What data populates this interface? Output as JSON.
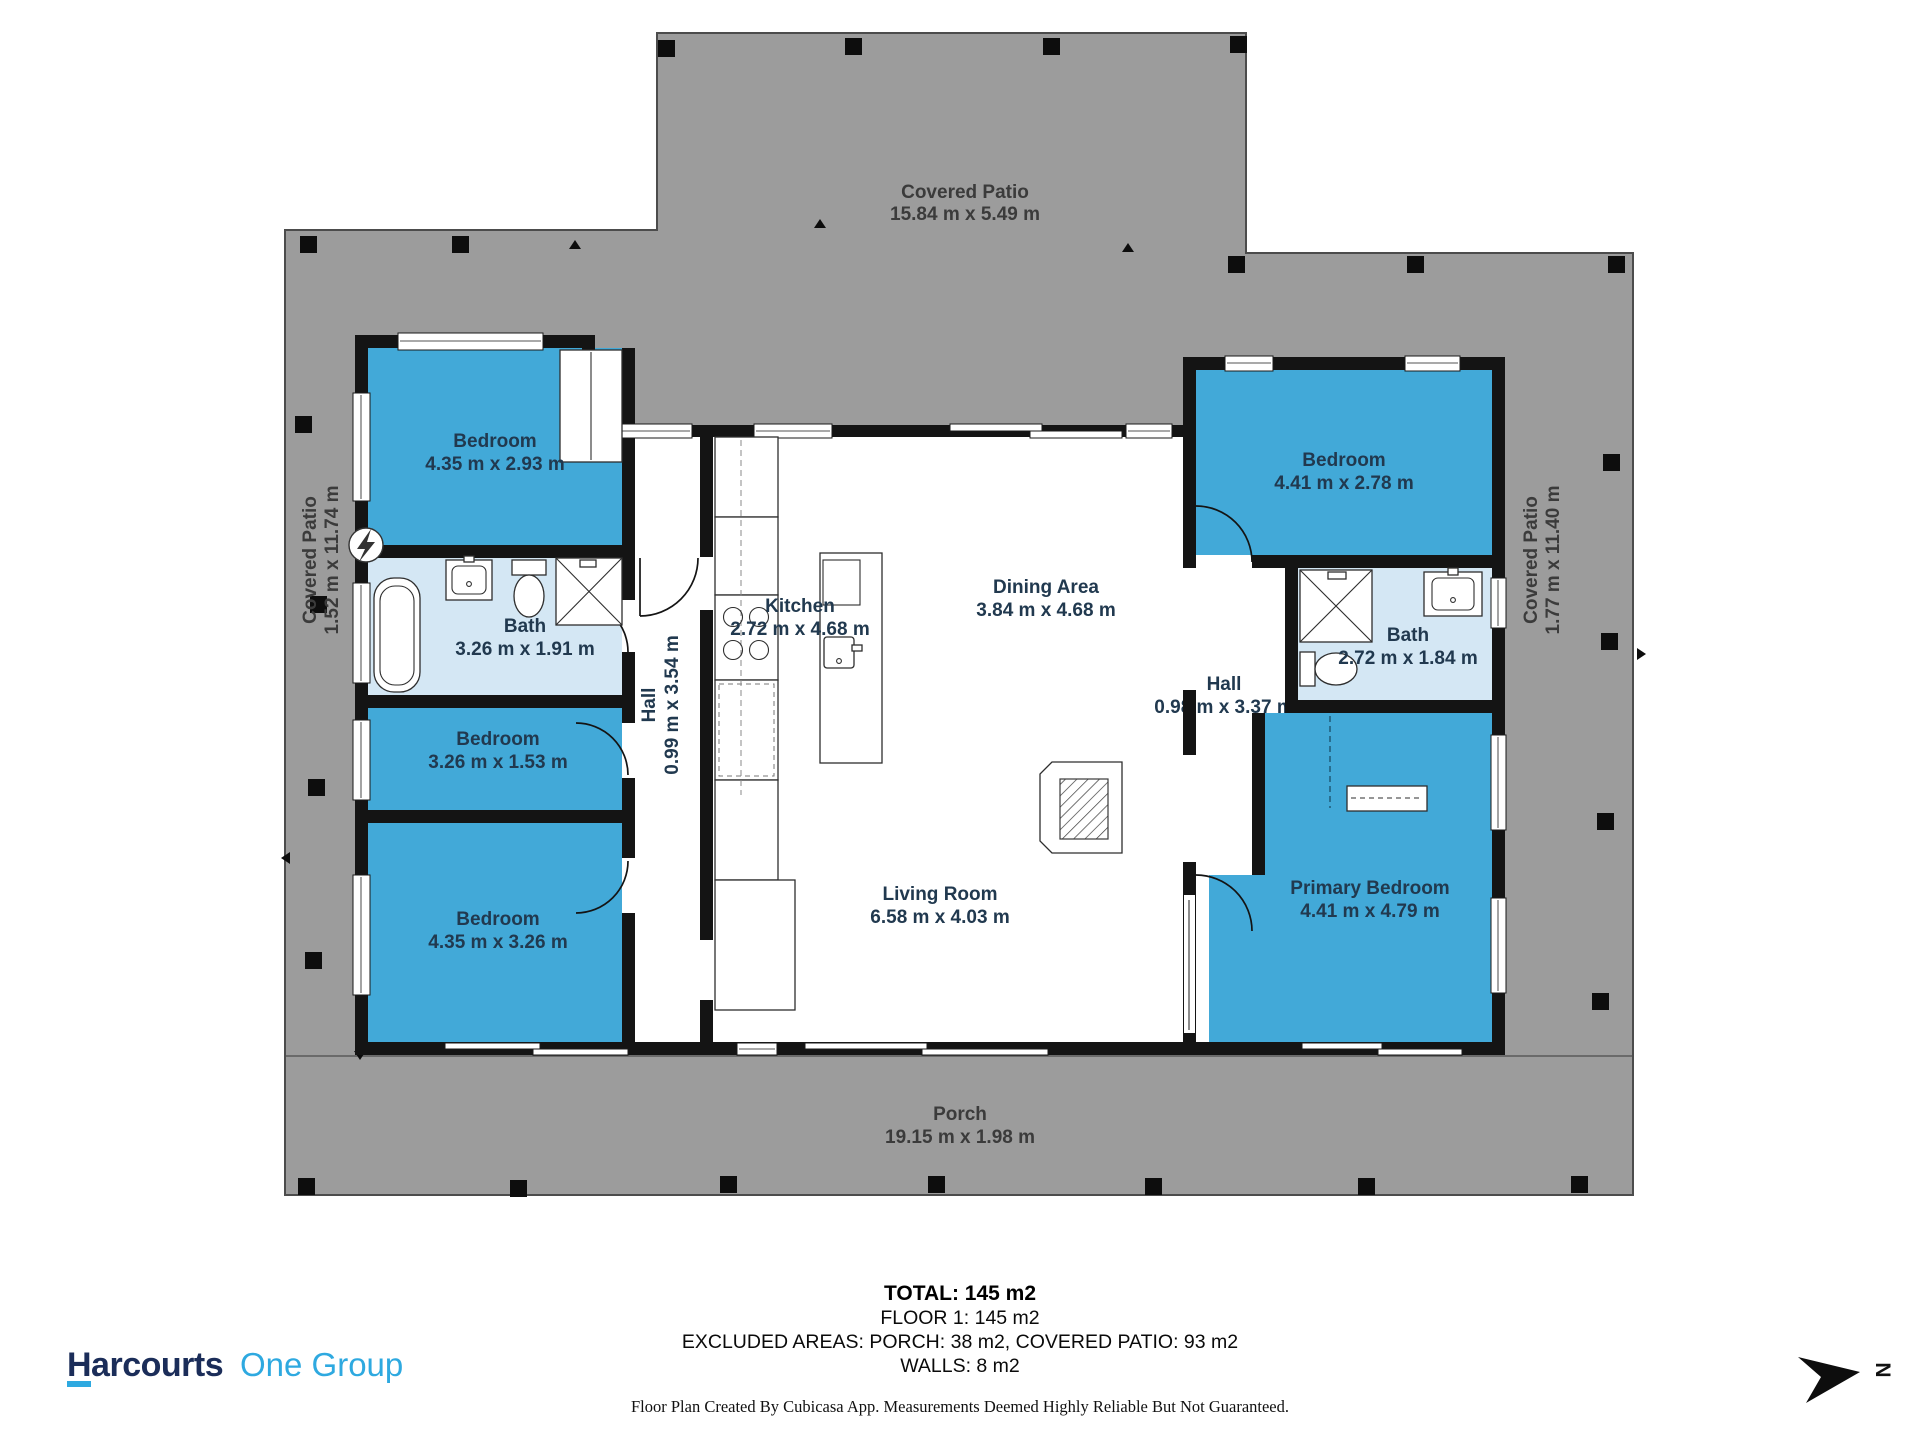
{
  "rooms": [
    {
      "name": "Bedroom",
      "dims": "4.35 m x 2.93 m"
    },
    {
      "name": "Bath",
      "dims": "3.26 m x 1.91 m"
    },
    {
      "name": "Bedroom",
      "dims": "3.26 m x 1.53 m"
    },
    {
      "name": "Bedroom",
      "dims": "4.35 m x 3.26 m"
    },
    {
      "name": "Hall",
      "dims": "0.99 m x 3.54 m"
    },
    {
      "name": "Kitchen",
      "dims": "2.72 m x 4.68 m"
    },
    {
      "name": "Dining Area",
      "dims": "3.84 m x 4.68 m"
    },
    {
      "name": "Living Room",
      "dims": "6.58 m x 4.03 m"
    },
    {
      "name": "Bedroom",
      "dims": "4.41 m x 2.78 m"
    },
    {
      "name": "Bath",
      "dims": "2.72 m x 1.84 m"
    },
    {
      "name": "Hall",
      "dims": "0.98 m x 3.37 m"
    },
    {
      "name": "Primary Bedroom",
      "dims": "4.41 m x 4.79 m"
    }
  ],
  "outdoor": [
    {
      "name": "Covered Patio",
      "dims": "15.84 m x 5.49 m"
    },
    {
      "name": "Covered Patio",
      "dims": "1.52 m x 11.74 m"
    },
    {
      "name": "Covered Patio",
      "dims": "1.77 m x 11.40 m"
    },
    {
      "name": "Porch",
      "dims": "19.15 m x 1.98 m"
    }
  ],
  "summary": {
    "total": "TOTAL: 145 m2",
    "floor": "FLOOR 1: 145 m2",
    "excluded": "EXCLUDED AREAS: PORCH: 38 m2, COVERED PATIO: 93 m2",
    "walls": "WALLS: 8 m2"
  },
  "disclaimer": "Floor Plan Created By Cubicasa App. Measurements Deemed Highly Reliable But Not Guaranteed.",
  "branding": {
    "brand": "Harcourts",
    "suffix": "One Group"
  },
  "compass": {
    "label": "N"
  },
  "colors": {
    "patio_gray": "#9c9c9c",
    "bedroom_blue": "#42a9d8",
    "bath_blue": "#d4e7f4",
    "wall_black": "#141414",
    "room_label": "#21394f",
    "outdoor_label": "#3b3b3b",
    "brand_navy": "#1b2d59",
    "brand_blue": "#2ea9e0"
  }
}
